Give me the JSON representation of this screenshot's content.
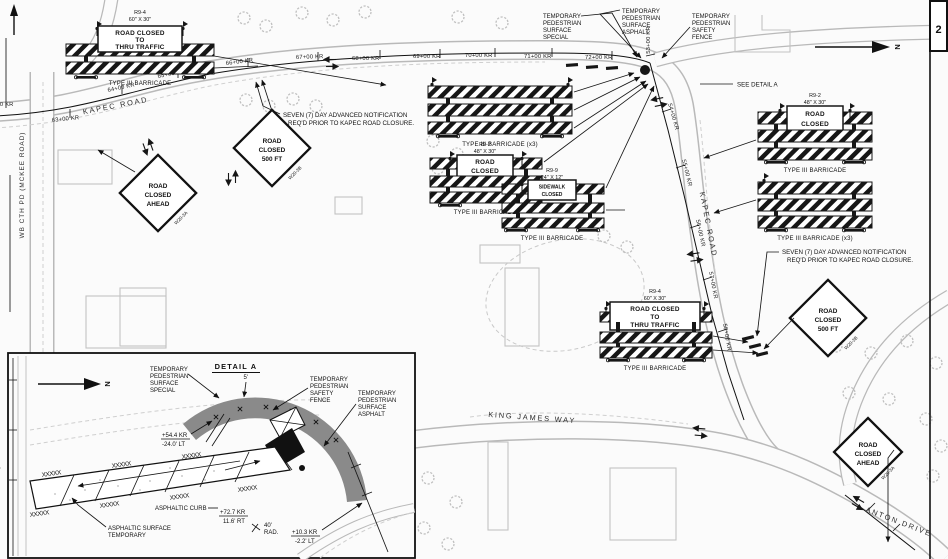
{
  "sheet": {
    "page_number": "2",
    "north_label": "N"
  },
  "roads": {
    "kapec": "KAPEC ROAD",
    "wb_cth_pd": "WB CTH PD (MCKEE ROAD)",
    "king_james": "KING JAMES WAY",
    "anton": "ANTON DRIVE"
  },
  "stations_top": [
    "62+00 KR",
    "63+00 KR",
    "64+00 KR",
    "65+00 KR",
    "66+00 KR",
    "67+00 KR",
    "68+00 KR",
    "69+00 KR",
    "70+00 KR",
    "71+00 KR",
    "72+00 KR"
  ],
  "stations_right": [
    "53+00 KR",
    "54+00 KR",
    "55+00 KR",
    "56+00 KR",
    "57+00 KR",
    "58+00 KR"
  ],
  "notes": {
    "seven_day_line1": "SEVEN (7) DAY ADVANCED NOTIFICATION",
    "seven_day_line2": "REQ'D PRIOR TO KAPEC ROAD CLOSURE.",
    "see_detail_a": "SEE DETAIL A"
  },
  "ped_labels": {
    "special": [
      "TEMPORARY",
      "PEDESTRIAN",
      "SURFACE",
      "SPECIAL"
    ],
    "asphalt": [
      "TEMPORARY",
      "PEDESTRIAN",
      "SURFACE",
      "ASPHALT"
    ],
    "fence": [
      "TEMPORARY",
      "PEDESTRIAN",
      "SAFETY",
      "FENCE"
    ]
  },
  "barricade_labels": {
    "type3": "TYPE III BARRICADE",
    "type3_x3": "TYPE III BARRICADE (x3)"
  },
  "signs": {
    "r9_4": {
      "designation": "R9-4",
      "size": "60\" X 30\"",
      "lines": [
        "ROAD CLOSED",
        "TO",
        "THRU TRAFFIC"
      ]
    },
    "r9_2": {
      "designation": "R9-2",
      "size": "48\" X 30\"",
      "lines": [
        "ROAD",
        "CLOSED"
      ]
    },
    "r9_9": {
      "designation": "R9-9",
      "size": "24\" X 12\"",
      "lines": [
        "SIDEWALK",
        "CLOSED"
      ]
    },
    "w20_3a": {
      "lines": [
        "ROAD",
        "CLOSED",
        "AHEAD"
      ],
      "designation": "W20-3A"
    },
    "w20_3b": {
      "lines": [
        "ROAD",
        "CLOSED",
        "500 FT"
      ],
      "designation": "W20-3B"
    }
  },
  "detail_a": {
    "title": "DETAIL A",
    "dim_5ft": "5'",
    "sta_offset_1": [
      "+54.4 KR",
      "-24.0' LT"
    ],
    "asphaltic_curb": "ASPHALTIC CURB",
    "sta_offset_2": [
      "+72.7 KR",
      "11.6' RT"
    ],
    "radius": [
      "40'",
      "RAD."
    ],
    "sta_offset_3": [
      "+10.3 KR",
      "-2.2' LT"
    ],
    "asphaltic_surface": [
      "ASPHALTIC SURFACE",
      "TEMPORARY"
    ],
    "hatch": "XXXXX"
  }
}
